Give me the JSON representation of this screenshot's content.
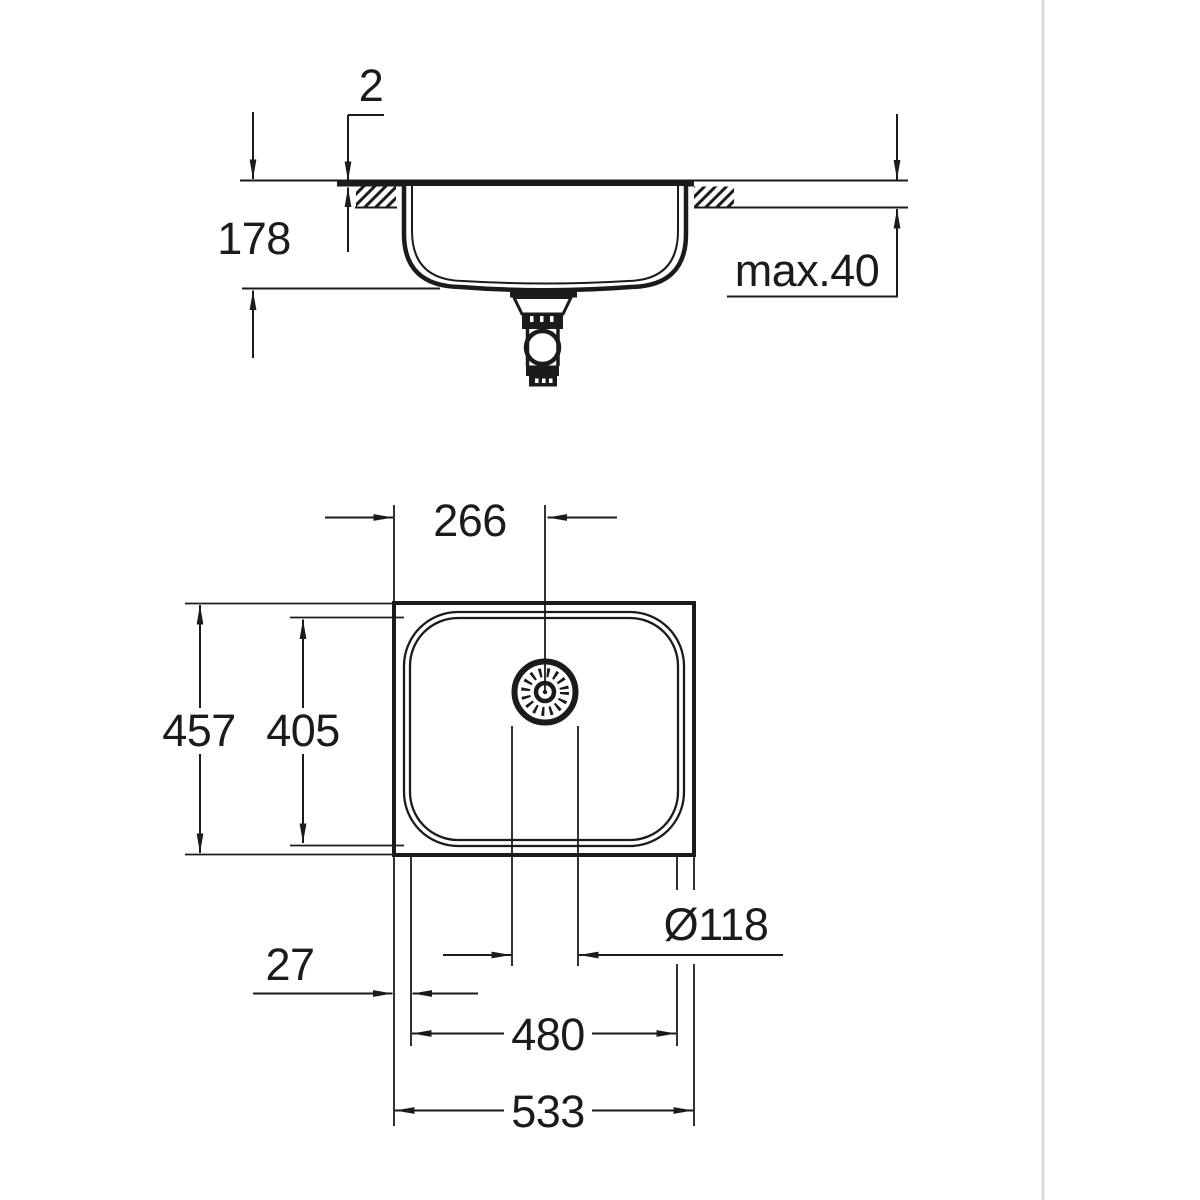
{
  "drawing_title": "sink-installation-dimension-drawing",
  "colors": {
    "line": "#1b1b1b",
    "divider": "#d5d5d5",
    "background": "#ffffff"
  },
  "side_view": {
    "rim_height_above_counter": "2",
    "bowl_depth": "178",
    "countertop_thickness": "max.40"
  },
  "plan_view": {
    "drain_center_from_left_edge": "266",
    "overall_depth": "457",
    "bowl_inner_depth": "405",
    "drain_diameter": "Ø118",
    "rim_to_bowl_offset": "27",
    "bowl_inner_width": "480",
    "overall_width": "533"
  }
}
